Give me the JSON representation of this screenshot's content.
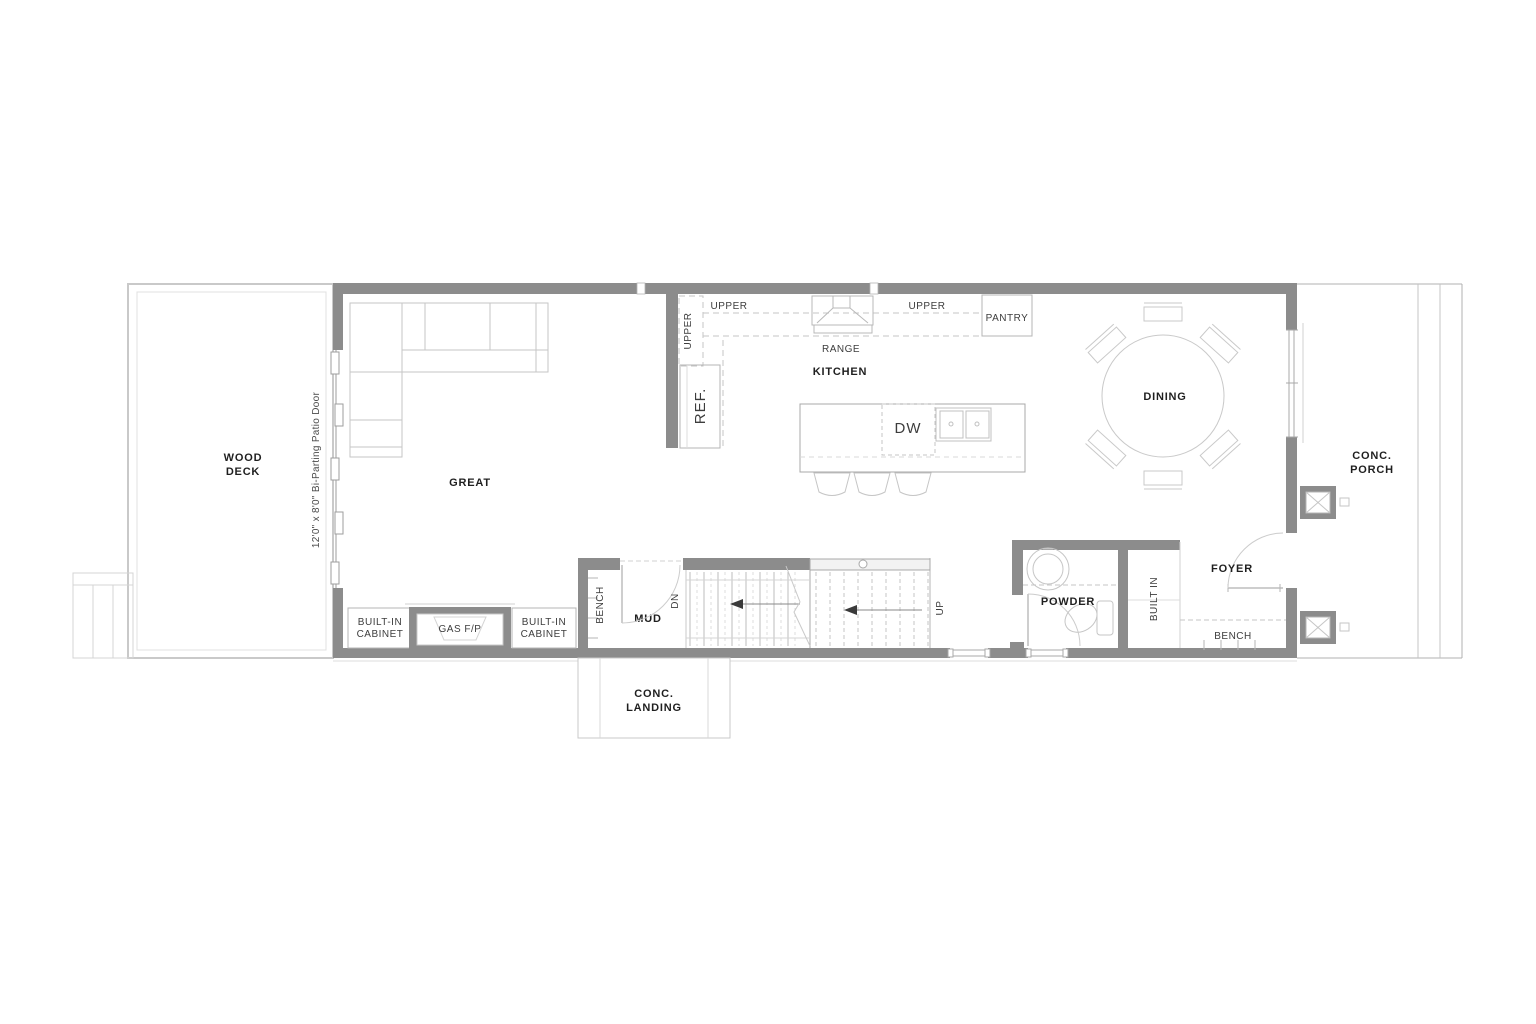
{
  "drawing": {
    "type": "residential-main-floor-plan",
    "colors": {
      "wall": "#8c8c8c",
      "structure_line": "#a8a8a8",
      "fixture_line": "#c6c6c6",
      "label_text": "#1f1f1f",
      "background": "#ffffff"
    },
    "labels": {
      "wood_deck_1": "WOOD",
      "wood_deck_2": "DECK",
      "patio_door": "12'0\" x 8'0\" Bi-Parting Patio Door",
      "great": "GREAT",
      "builtin_cabinet_left_1": "BUILT-IN",
      "builtin_cabinet_left_2": "CABINET",
      "gas_fp": "GAS F/P",
      "builtin_cabinet_right_1": "BUILT-IN",
      "builtin_cabinet_right_2": "CABINET",
      "bench_mud": "BENCH",
      "mud": "MUD",
      "dn": "DN",
      "up": "UP",
      "conc_landing_1": "CONC.",
      "conc_landing_2": "LANDING",
      "upper_left_vertical": "UPPER",
      "upper_left": "UPPER",
      "range": "RANGE",
      "kitchen": "KITCHEN",
      "upper_right": "UPPER",
      "pantry": "PANTRY",
      "ref": "REF.",
      "dw": "DW",
      "dining": "DINING",
      "powder": "POWDER",
      "built_in": "BUILT IN",
      "foyer": "FOYER",
      "bench_foyer": "BENCH",
      "conc_porch_1": "CONC.",
      "conc_porch_2": "PORCH"
    }
  }
}
